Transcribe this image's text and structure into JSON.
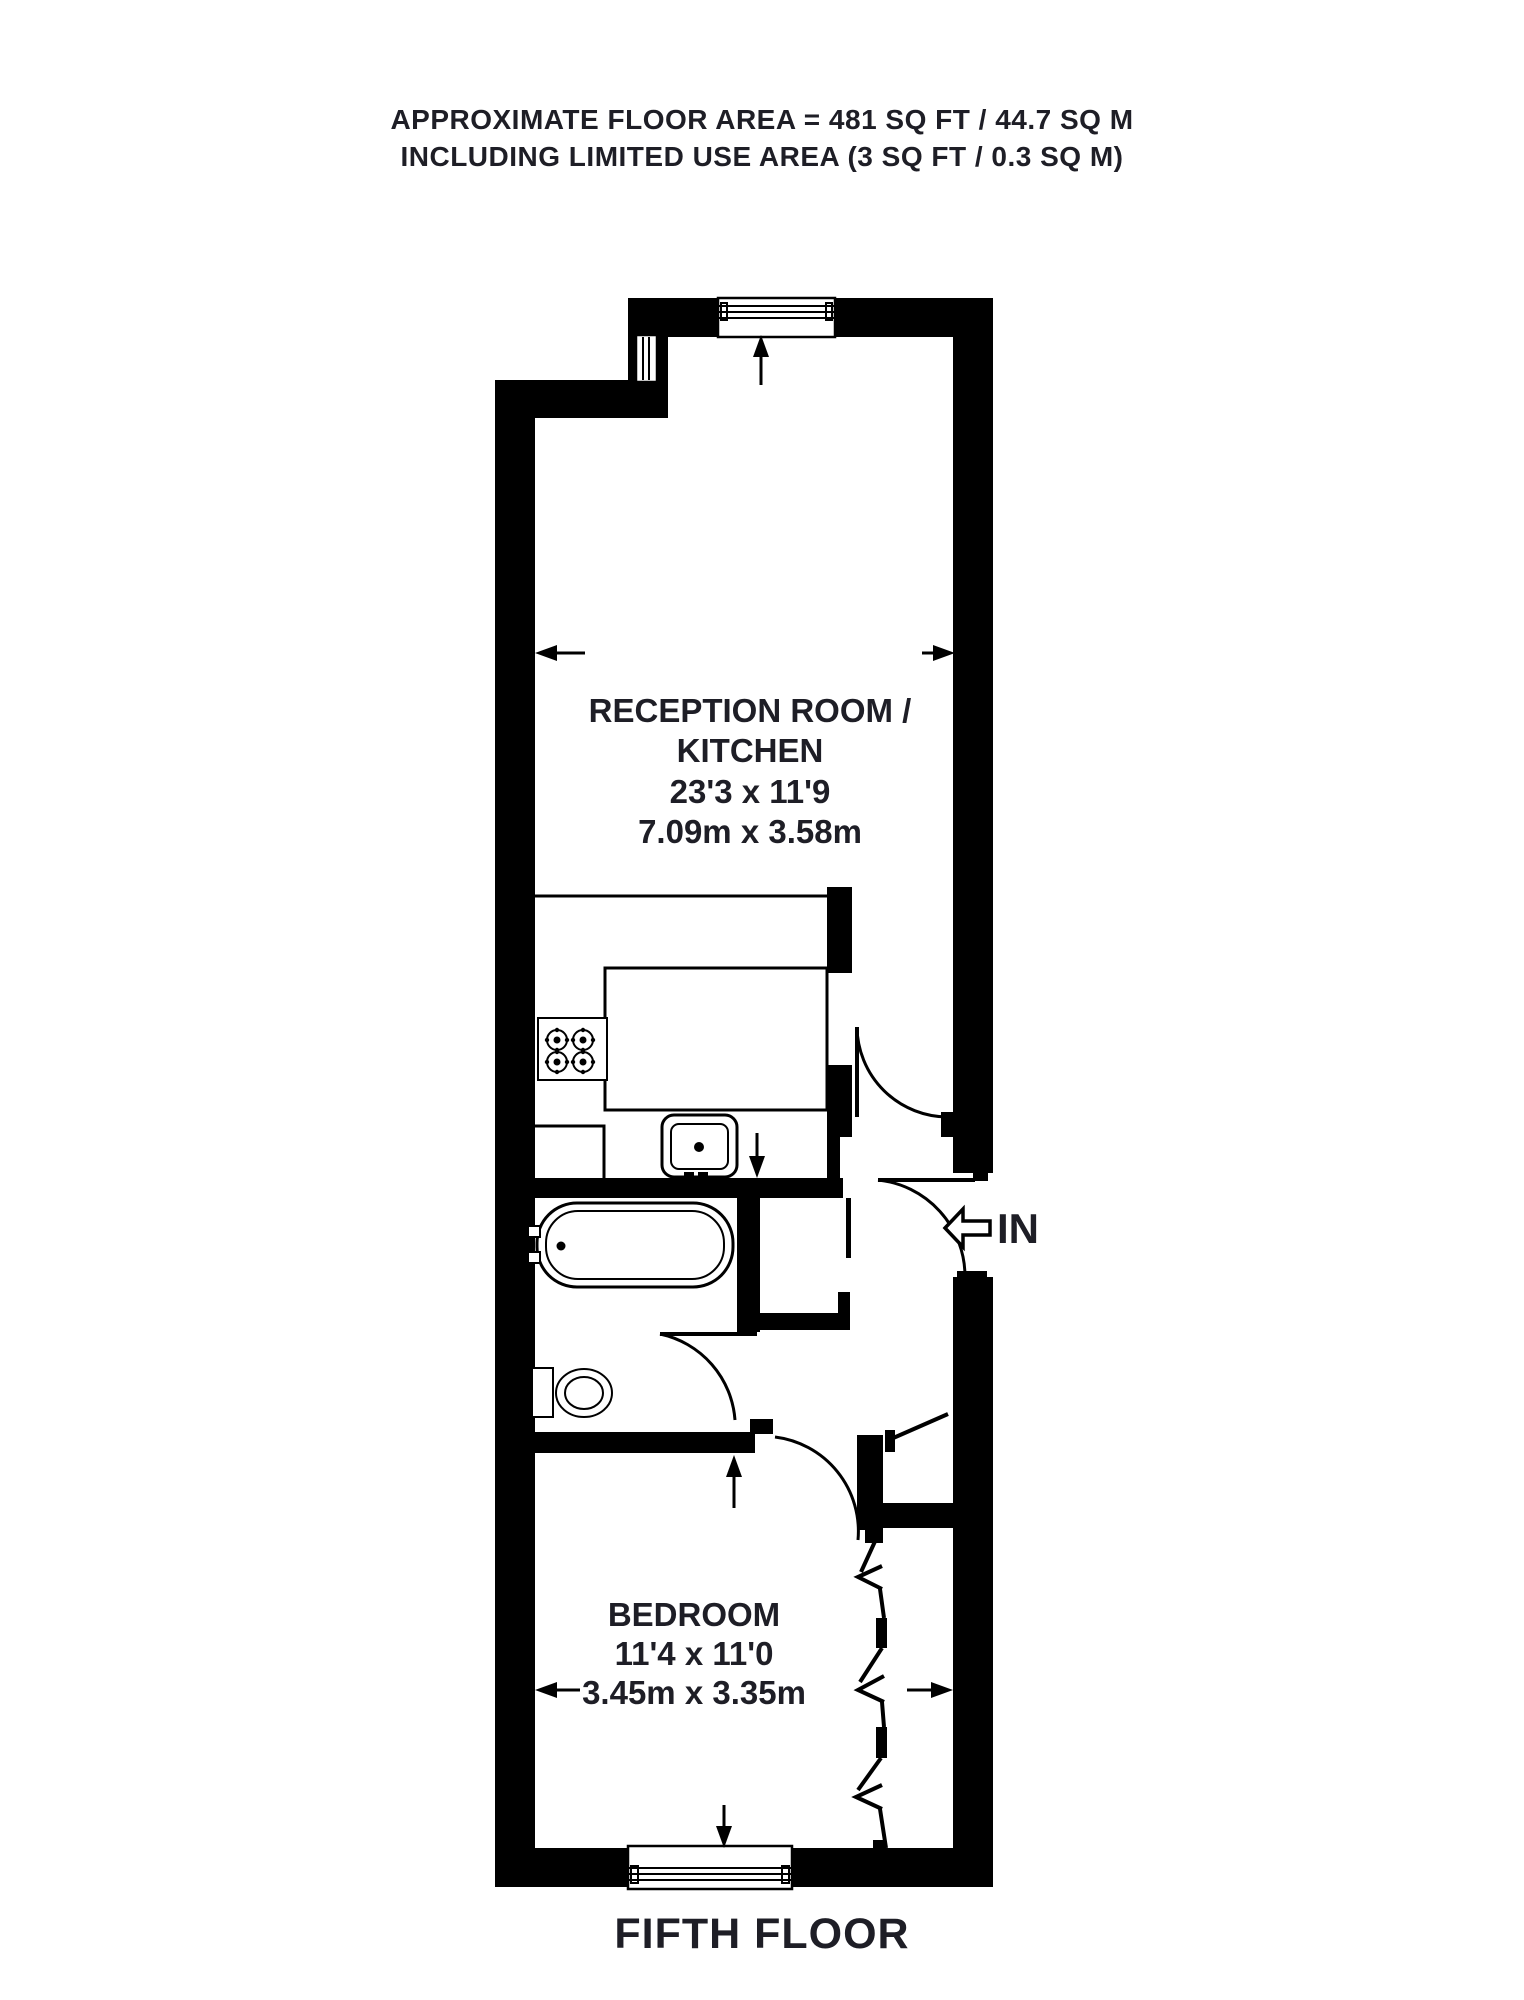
{
  "header": {
    "line1": "APPROXIMATE FLOOR AREA = 481 SQ FT / 44.7 SQ M",
    "line2": "INCLUDING LIMITED USE AREA (3 SQ FT / 0.3 SQ M)"
  },
  "rooms": {
    "reception": {
      "name_line1": "RECEPTION ROOM /",
      "name_line2": "KITCHEN",
      "dimensions_imperial": "23'3 x 11'9",
      "dimensions_metric": "7.09m x 3.58m"
    },
    "bedroom": {
      "name": "BEDROOM",
      "dimensions_imperial": "11'4 x 11'0",
      "dimensions_metric": "3.45m x 3.35m"
    }
  },
  "entrance": {
    "label": "IN"
  },
  "caption": "FIFTH FLOOR",
  "colors": {
    "wall": "#000000",
    "text": "#1e1e26",
    "background": "#ffffff"
  }
}
